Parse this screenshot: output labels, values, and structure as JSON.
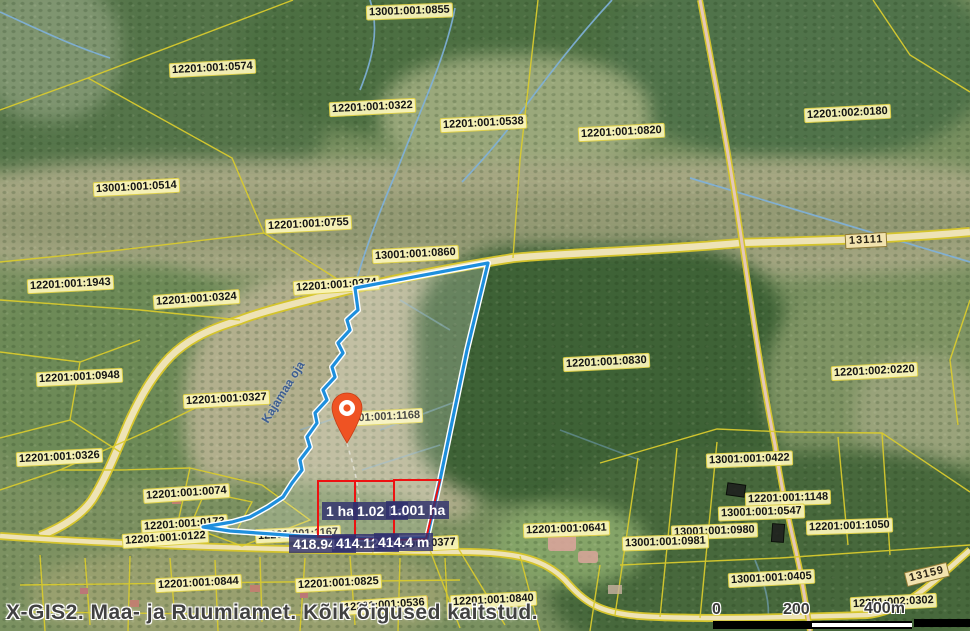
{
  "attribution": "X-GIS2. Maa- ja Ruumiamet. Kõik õigused kaitstud.",
  "scalebar": {
    "tick_0": "0",
    "tick_200": "200",
    "tick_400": "400m"
  },
  "parcel_labels": [
    {
      "text": "13001:001:0855",
      "x": 366,
      "y": 4,
      "rot": -2
    },
    {
      "text": "12201:001:0574",
      "x": 169,
      "y": 61,
      "rot": -3
    },
    {
      "text": "12201:001:0322",
      "x": 329,
      "y": 100,
      "rot": -3
    },
    {
      "text": "12201:001:0538",
      "x": 440,
      "y": 116,
      "rot": -3
    },
    {
      "text": "12201:001:0820",
      "x": 578,
      "y": 125,
      "rot": -3
    },
    {
      "text": "12201:002:0180",
      "x": 804,
      "y": 106,
      "rot": -3
    },
    {
      "text": "13001:001:0514",
      "x": 93,
      "y": 180,
      "rot": -3
    },
    {
      "text": "12201:001:0755",
      "x": 265,
      "y": 217,
      "rot": -3
    },
    {
      "text": "13001:001:0860",
      "x": 372,
      "y": 247,
      "rot": -3
    },
    {
      "text": "12201:001:0374",
      "x": 293,
      "y": 278,
      "rot": -4
    },
    {
      "text": "12201:001:1943",
      "x": 27,
      "y": 277,
      "rot": -3
    },
    {
      "text": "12201:001:0324",
      "x": 153,
      "y": 292,
      "rot": -4
    },
    {
      "text": "12201:001:0948",
      "x": 36,
      "y": 370,
      "rot": -3
    },
    {
      "text": "12201:001:0327",
      "x": 183,
      "y": 392,
      "rot": -3
    },
    {
      "text": "12201:001:0830",
      "x": 563,
      "y": 355,
      "rot": -3
    },
    {
      "text": "12201:002:0220",
      "x": 831,
      "y": 364,
      "rot": -3
    },
    {
      "text": "12201:001:0326",
      "x": 16,
      "y": 450,
      "rot": -3
    },
    {
      "text": "13001:001:0422",
      "x": 706,
      "y": 452,
      "rot": -2
    },
    {
      "text": "12201:001:0074",
      "x": 143,
      "y": 486,
      "rot": -4
    },
    {
      "text": "12201:001:1148",
      "x": 745,
      "y": 491,
      "rot": -2
    },
    {
      "text": "13001:001:0547",
      "x": 718,
      "y": 505,
      "rot": -2
    },
    {
      "text": "12201:001:1050",
      "x": 806,
      "y": 519,
      "rot": -2
    },
    {
      "text": "13001:001:0980",
      "x": 671,
      "y": 524,
      "rot": -2
    },
    {
      "text": "13001:001:0981",
      "x": 622,
      "y": 535,
      "rot": -2
    },
    {
      "text": "12201:001:0173",
      "x": 141,
      "y": 517,
      "rot": -4
    },
    {
      "text": "12201:001:0122",
      "x": 122,
      "y": 531,
      "rot": -4
    },
    {
      "text": "12201:001:1167",
      "x": 255,
      "y": 527,
      "rot": -3
    },
    {
      "text": "12201:001:0377",
      "x": 372,
      "y": 537,
      "rot": -3
    },
    {
      "text": "12201:001:0641",
      "x": 523,
      "y": 522,
      "rot": -2
    },
    {
      "text": "12201:001:0844",
      "x": 155,
      "y": 576,
      "rot": -3
    },
    {
      "text": "12201:001:0825",
      "x": 295,
      "y": 576,
      "rot": -3
    },
    {
      "text": "12201:001:0536",
      "x": 341,
      "y": 598,
      "rot": -4
    },
    {
      "text": "12201:001:0840",
      "x": 450,
      "y": 593,
      "rot": -3
    },
    {
      "text": "13001:001:0405",
      "x": 728,
      "y": 571,
      "rot": -3
    },
    {
      "text": "12201:002:0302",
      "x": 850,
      "y": 595,
      "rot": -3
    }
  ],
  "road_labels": [
    {
      "text": "13111",
      "x": 845,
      "y": 233,
      "rot": -3
    },
    {
      "text": "13159",
      "x": 905,
      "y": 567,
      "rot": -14
    }
  ],
  "stream_label": {
    "text": "Kajamaa oja",
    "x": 248,
    "y": 385,
    "rot": -58
  },
  "marker": {
    "label": "12201:001:1168",
    "label_x": 337,
    "label_y": 410
  },
  "measurements": {
    "areas": [
      {
        "text": "1 ha",
        "x": 322,
        "y": 502
      },
      {
        "text": "1.02 ha",
        "x": 353,
        "y": 502
      },
      {
        "text": "1.001 ha",
        "x": 386,
        "y": 501
      }
    ],
    "lengths": [
      {
        "text": "418.94 m",
        "x": 289,
        "y": 535
      },
      {
        "text": "414.12 m",
        "x": 332,
        "y": 534
      },
      {
        "text": "414.4 m",
        "x": 374,
        "y": 533
      }
    ]
  },
  "colors": {
    "parcel_line": "#d9cb2e",
    "highlight_outline": "#1e8fdd",
    "measure_rect": "#ee1111",
    "badge_bg": "#30306e",
    "marker": "#ef5323",
    "label_bg": "#fcf6ba"
  }
}
